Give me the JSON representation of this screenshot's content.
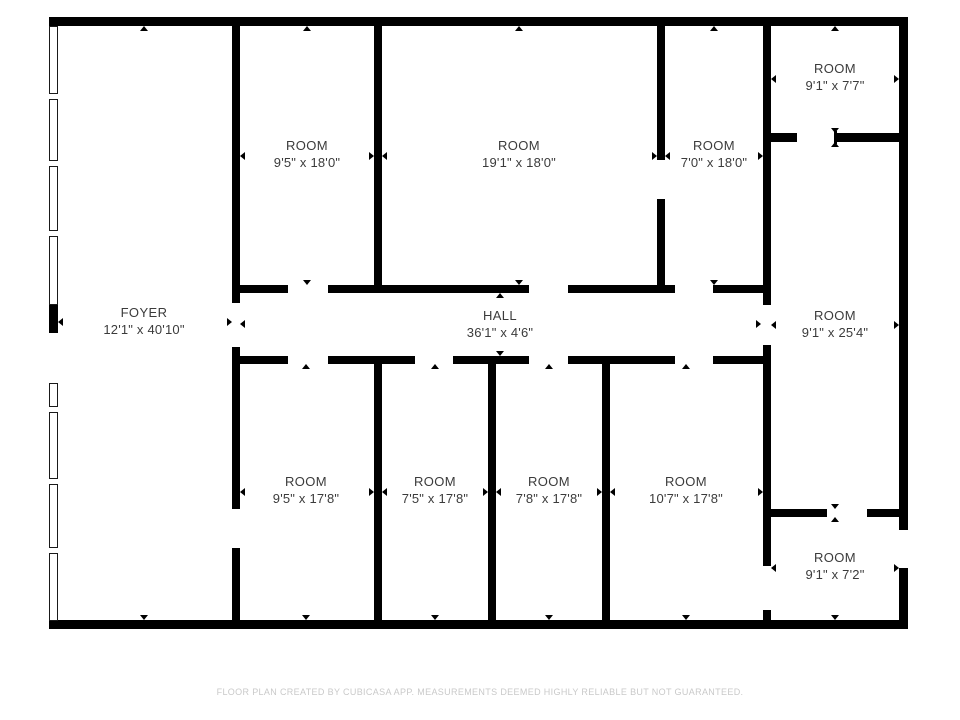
{
  "plan": {
    "rooms": [
      {
        "id": "foyer",
        "name": "FOYER",
        "dims": "12'1\" x 40'10\""
      },
      {
        "id": "room-a",
        "name": "ROOM",
        "dims": "9'5\" x 18'0\""
      },
      {
        "id": "room-b",
        "name": "ROOM",
        "dims": "19'1\" x 18'0\""
      },
      {
        "id": "room-c",
        "name": "ROOM",
        "dims": "7'0\" x 18'0\""
      },
      {
        "id": "room-d",
        "name": "ROOM",
        "dims": "9'1\" x 7'7\""
      },
      {
        "id": "room-e",
        "name": "ROOM",
        "dims": "9'1\" x 25'4\""
      },
      {
        "id": "hall",
        "name": "HALL",
        "dims": "36'1\" x 4'6\""
      },
      {
        "id": "room-f",
        "name": "ROOM",
        "dims": "9'5\" x 17'8\""
      },
      {
        "id": "room-g",
        "name": "ROOM",
        "dims": "7'5\" x 17'8\""
      },
      {
        "id": "room-h",
        "name": "ROOM",
        "dims": "7'8\" x 17'8\""
      },
      {
        "id": "room-i",
        "name": "ROOM",
        "dims": "10'7\" x 17'8\""
      },
      {
        "id": "room-j",
        "name": "ROOM",
        "dims": "9'1\" x 7'2\""
      }
    ],
    "footer": "FLOOR PLAN CREATED BY CUBICASA APP. MEASUREMENTS DEEMED HIGHLY RELIABLE BUT NOT GUARANTEED.",
    "colors": {
      "wall": "#000000",
      "label_text": "#3b3b3b",
      "footer_text": "#c9c9c9",
      "background": "#ffffff"
    }
  }
}
